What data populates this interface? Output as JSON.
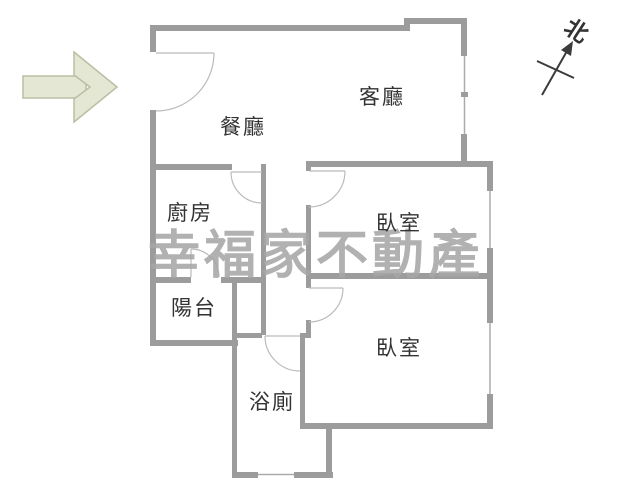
{
  "floor_plan": {
    "rooms": [
      {
        "id": "living-room",
        "label": "客廳"
      },
      {
        "id": "dining-room",
        "label": "餐廳"
      },
      {
        "id": "kitchen",
        "label": "廚房"
      },
      {
        "id": "bedroom-1",
        "label": "臥室"
      },
      {
        "id": "balcony",
        "label": "陽台"
      },
      {
        "id": "bedroom-2",
        "label": "臥室"
      },
      {
        "id": "bathroom",
        "label": "浴廁"
      }
    ],
    "compass": {
      "label": "北"
    },
    "watermark": {
      "text": "幸福家不動產"
    },
    "colors": {
      "wall": "#9c9c9c",
      "thin": "#ababab",
      "door": "#bbbbbb",
      "text": "#333333",
      "watermark": "#a7a7a7",
      "arrow_fill": "#e4e7d3",
      "arrow_stroke": "#b9bfa4",
      "compass": "#3c3c3c"
    }
  }
}
